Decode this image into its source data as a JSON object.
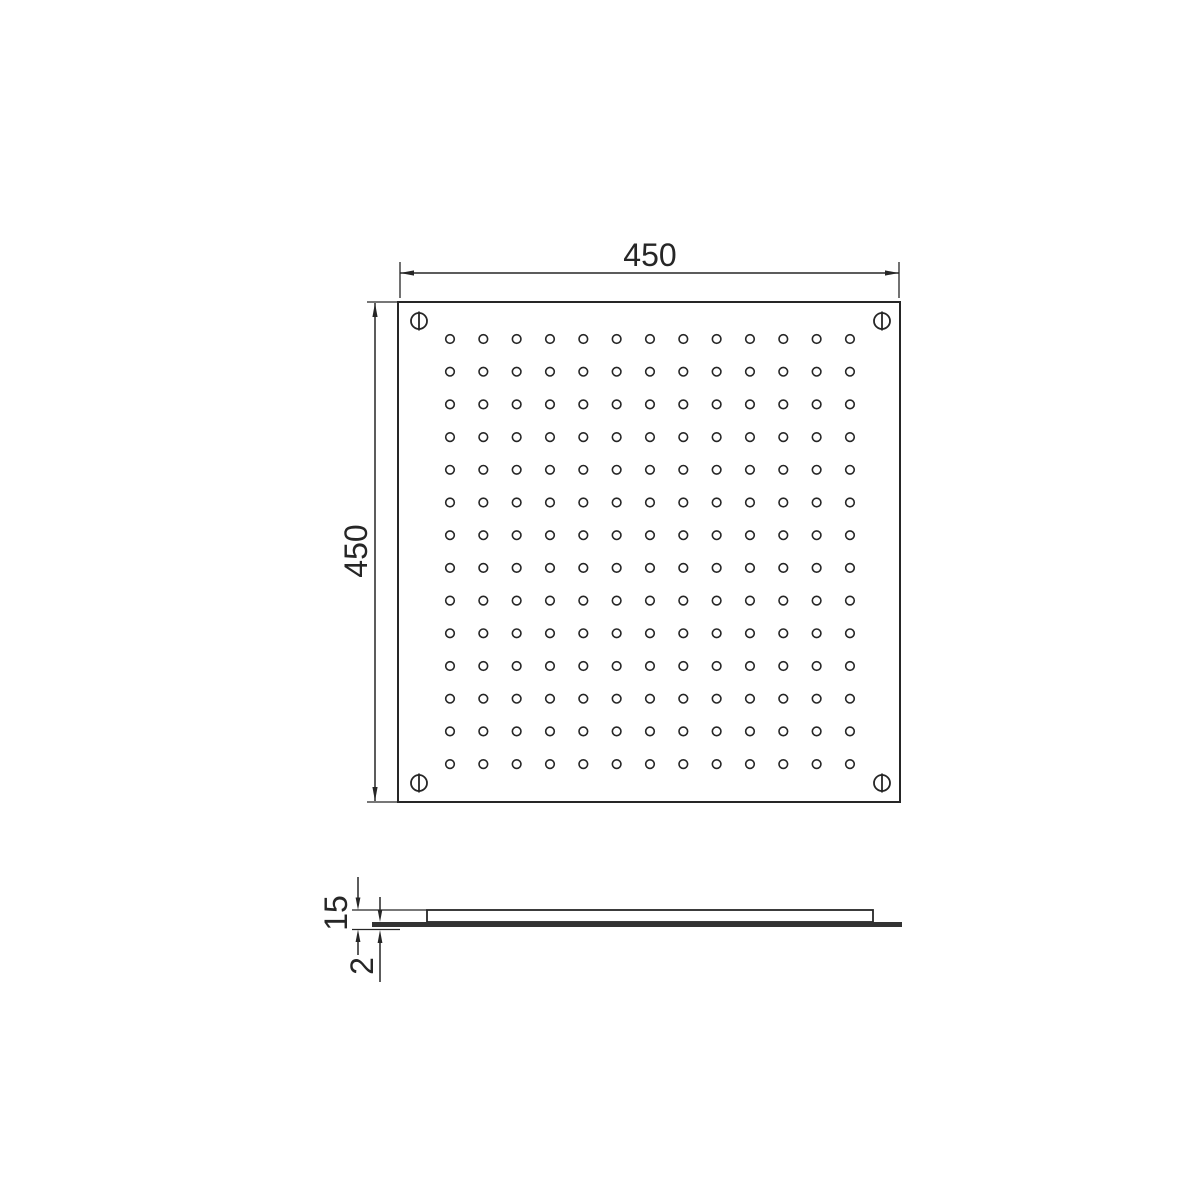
{
  "drawing": {
    "kind": "technical-drawing",
    "plan_view": {
      "width_dim_label": "450",
      "height_dim_label": "450",
      "hole_grid": {
        "columns": 13,
        "rows": 14
      },
      "corner_screw_count": 4
    },
    "side_view": {
      "total_thickness_dim_label": "15",
      "face_plate_thickness_dim_label": "2"
    },
    "colors": {
      "line": "#262626",
      "background": "#ffffff",
      "face_plate_bar": "#333333"
    }
  }
}
